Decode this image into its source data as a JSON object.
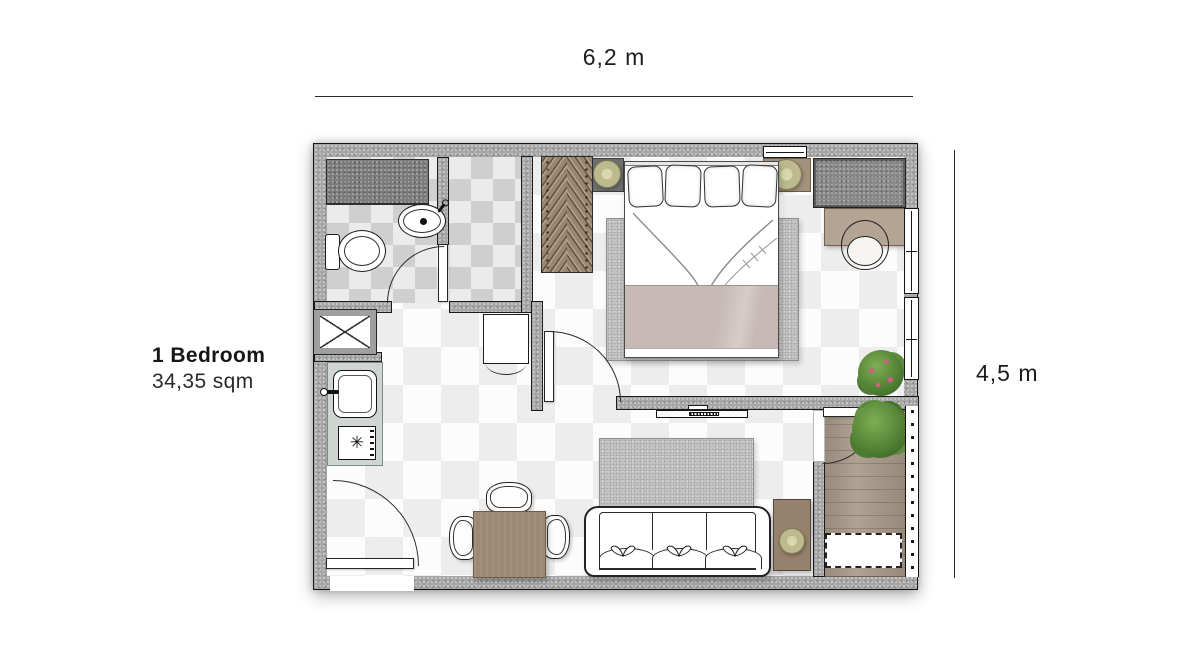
{
  "labels": {
    "title": "1 Bedroom",
    "area": "34,35 sqm",
    "width_dim": "6,2 m",
    "height_dim": "4,5 m"
  },
  "colors": {
    "wall": "#a6a6a6",
    "wall_dark": "#7d7d7d",
    "cabinet": "#8a8a8a",
    "wardrobe": "#9b8570",
    "desk": "#b3a494",
    "blanket": "#c6b9b6",
    "counter": "#cfd6d2",
    "deck": "#a89a8a",
    "wood": "#9c8a75",
    "wood_dark": "#96816c",
    "lamp": "#bcba8e",
    "plant": "#4c7a30",
    "flower": "#c9617f",
    "rug": "#c3c3c3",
    "tile_dark": "#cfcfcf",
    "tile_light": "#ebebeb",
    "floor_light": "#fcfcfc",
    "floor_shade": "#ededed"
  },
  "rooms": [
    "bathroom",
    "walk-in-closet",
    "bedroom",
    "living-room",
    "kitchen",
    "balcony"
  ],
  "furniture": [
    "shower",
    "toilet",
    "washbasin",
    "wardrobe-hangers",
    "double-bed",
    "pillows",
    "bedside-lamp-left",
    "bedside-lamp-right",
    "wall-cabinet",
    "desk",
    "desk-chair",
    "bedroom-plant",
    "tv",
    "sofa",
    "living-rug",
    "bedroom-rug",
    "side-table",
    "table-lamp",
    "dining-table",
    "dining-chairs",
    "service-shaft",
    "kitchen-counter",
    "kitchen-sink",
    "stove",
    "refrigerator",
    "entrance-door",
    "bathroom-door",
    "bedroom-door",
    "balcony-door",
    "balcony-deck",
    "balcony-plant",
    "washing-machine-space",
    "balcony-railing",
    "windows"
  ]
}
